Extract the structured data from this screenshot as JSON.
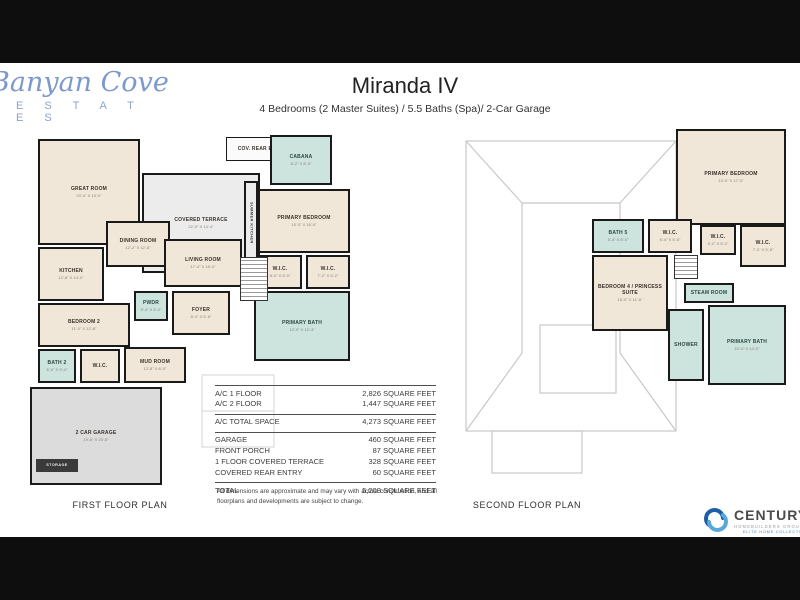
{
  "brand": {
    "script": "Banyan Cove",
    "estates": "E S T A T E S",
    "color": "#7d99cc"
  },
  "header": {
    "title": "Miranda IV",
    "subtitle": "4 Bedrooms (2 Master Suites) / 5.5 Baths (Spa)/ 2-Car Garage"
  },
  "area_table": {
    "groups": [
      {
        "rows": [
          {
            "label": "A/C 1 FLOOR",
            "value": "2,826 SQUARE FEET"
          },
          {
            "label": "A/C 2 FLOOR",
            "value": "1,447 SQUARE FEET"
          }
        ]
      },
      {
        "rows": [
          {
            "label": "A/C TOTAL SPACE",
            "value": "4,273 SQUARE FEET"
          }
        ]
      },
      {
        "rows": [
          {
            "label": "GARAGE",
            "value": "460 SQUARE FEET"
          },
          {
            "label": "FRONT PORCH",
            "value": "87 SQUARE FEET"
          },
          {
            "label": "1 FLOOR COVERED TERRACE",
            "value": "328 SQUARE FEET"
          },
          {
            "label": "COVERED REAR ENTRY",
            "value": "60 SQUARE FEET"
          }
        ]
      },
      {
        "rows": [
          {
            "label": "TOTAL",
            "value": "5,208 SQUARE FEET"
          }
        ]
      }
    ]
  },
  "disclaimer": "All dimensions are approximate and may vary with actual construction, and all floorplans and developments are subject to change.",
  "plans": [
    {
      "caption": "FIRST FLOOR PLAN",
      "rooms": [
        {
          "label": "GREAT ROOM",
          "dims": "20'-0\" X 19'-0\"",
          "x": 8,
          "y": 12,
          "w": 102,
          "h": 106,
          "fill": "beige"
        },
        {
          "label": "COVERED TERRACE",
          "dims": "22'-0\" X 14'-4\"",
          "x": 112,
          "y": 46,
          "w": 118,
          "h": 100,
          "fill": "terrace"
        },
        {
          "label": "SUMMER KITCHEN",
          "x": 214,
          "y": 54,
          "w": 14,
          "h": 84,
          "fill": "terrace",
          "vertical": true
        },
        {
          "label": "COV. REAR ENTRY",
          "x": 196,
          "y": 10,
          "w": 72,
          "h": 24,
          "fill": "white"
        },
        {
          "label": "CABANA",
          "dims": "8'-2\" X 8'-0\"",
          "x": 240,
          "y": 8,
          "w": 62,
          "h": 50,
          "fill": "bath"
        },
        {
          "label": "PRIMARY BEDROOM",
          "dims": "15'-0\" X 16'-0\"",
          "x": 228,
          "y": 62,
          "w": 92,
          "h": 64,
          "fill": "beige"
        },
        {
          "label": "W.I.C.",
          "dims": "8'-0\" X 5'-0\"",
          "x": 228,
          "y": 128,
          "w": 44,
          "h": 34,
          "fill": "beige"
        },
        {
          "label": "W.I.C.",
          "dims": "7'-2\" X 5'-2\"",
          "x": 276,
          "y": 128,
          "w": 44,
          "h": 34,
          "fill": "beige"
        },
        {
          "label": "PRIMARY BATH",
          "dims": "12'-0\" X 12'-4\"",
          "x": 224,
          "y": 164,
          "w": 96,
          "h": 70,
          "fill": "bath"
        },
        {
          "label": "DINING ROOM",
          "dims": "12'-2\" X 12'-8\"",
          "x": 76,
          "y": 94,
          "w": 64,
          "h": 46,
          "fill": "beige"
        },
        {
          "label": "KITCHEN",
          "dims": "12'-8\" X 14'-0\"",
          "x": 8,
          "y": 120,
          "w": 66,
          "h": 54,
          "fill": "beige"
        },
        {
          "label": "LIVING ROOM",
          "dims": "17'-4\" X 18'-0\"",
          "x": 134,
          "y": 112,
          "w": 78,
          "h": 48,
          "fill": "beige"
        },
        {
          "type": "stairs",
          "x": 210,
          "y": 130,
          "w": 28,
          "h": 44
        },
        {
          "label": "BEDROOM 2",
          "dims": "11'-0\" X 12'-8\"",
          "x": 8,
          "y": 176,
          "w": 92,
          "h": 44,
          "fill": "beige"
        },
        {
          "label": "PWDR",
          "dims": "5'-4\" X 5'-0\"",
          "x": 104,
          "y": 164,
          "w": 34,
          "h": 30,
          "fill": "bath"
        },
        {
          "label": "FOYER",
          "dims": "8'-4\" X 5'-8\"",
          "x": 142,
          "y": 164,
          "w": 58,
          "h": 44,
          "fill": "beige"
        },
        {
          "label": "BATH 2",
          "dims": "6'-0\" X 9'-4\"",
          "x": 8,
          "y": 222,
          "w": 38,
          "h": 34,
          "fill": "bath"
        },
        {
          "label": "W.I.C.",
          "x": 50,
          "y": 222,
          "w": 40,
          "h": 34,
          "fill": "beige"
        },
        {
          "label": "MUD ROOM",
          "dims": "12'-8\" X 6'-0\"",
          "x": 94,
          "y": 220,
          "w": 62,
          "h": 36,
          "fill": "beige"
        },
        {
          "label": "2 CAR GARAGE",
          "dims": "19'-8\" X 20'-8\"",
          "x": 0,
          "y": 260,
          "w": 132,
          "h": 98,
          "fill": "garage"
        },
        {
          "label": "STORAGE",
          "type": "tag",
          "x": 6,
          "y": 332,
          "w": 42,
          "h": 13
        }
      ]
    },
    {
      "caption": "SECOND FLOOR PLAN",
      "rooms": [
        {
          "label": "PRIMARY BEDROOM",
          "dims": "13'-0\" X 17'-0\"",
          "x": 224,
          "y": 16,
          "w": 110,
          "h": 96,
          "fill": "beige"
        },
        {
          "label": "W.I.C.",
          "dims": "5'-2\" X 5'-2\"",
          "x": 248,
          "y": 112,
          "w": 36,
          "h": 30,
          "fill": "beige"
        },
        {
          "label": "W.I.C.",
          "dims": "7'-0\" X 5'-8\"",
          "x": 288,
          "y": 112,
          "w": 46,
          "h": 42,
          "fill": "beige"
        },
        {
          "label": "BATH 5",
          "dims": "5'-4\" X 8'-0\"",
          "x": 140,
          "y": 106,
          "w": 52,
          "h": 34,
          "fill": "bath"
        },
        {
          "label": "W.I.C.",
          "dims": "6'-4\" X 5'-8\"",
          "x": 196,
          "y": 106,
          "w": 44,
          "h": 34,
          "fill": "beige"
        },
        {
          "label": "BEDROOM 4 / PRINCESS SUITE",
          "dims": "16'-0\" X 11'-6\"",
          "x": 140,
          "y": 142,
          "w": 76,
          "h": 76,
          "fill": "beige"
        },
        {
          "type": "stairs",
          "x": 222,
          "y": 142,
          "w": 24,
          "h": 24
        },
        {
          "label": "STEAM ROOM",
          "x": 232,
          "y": 170,
          "w": 50,
          "h": 20,
          "fill": "bath"
        },
        {
          "label": "PRIMARY BATH",
          "dims": "10'-4\" X 14'-0\"",
          "x": 256,
          "y": 192,
          "w": 78,
          "h": 80,
          "fill": "bath"
        },
        {
          "label": "SHOWER",
          "x": 216,
          "y": 196,
          "w": 36,
          "h": 72,
          "fill": "bath"
        }
      ]
    }
  ],
  "footer_logo": {
    "title": "CENTURY",
    "subtitle": "HOMEBUILDERS GROUP",
    "tagline": "ELITE HOME COLLECTION",
    "accent": "#2a7fc1"
  }
}
